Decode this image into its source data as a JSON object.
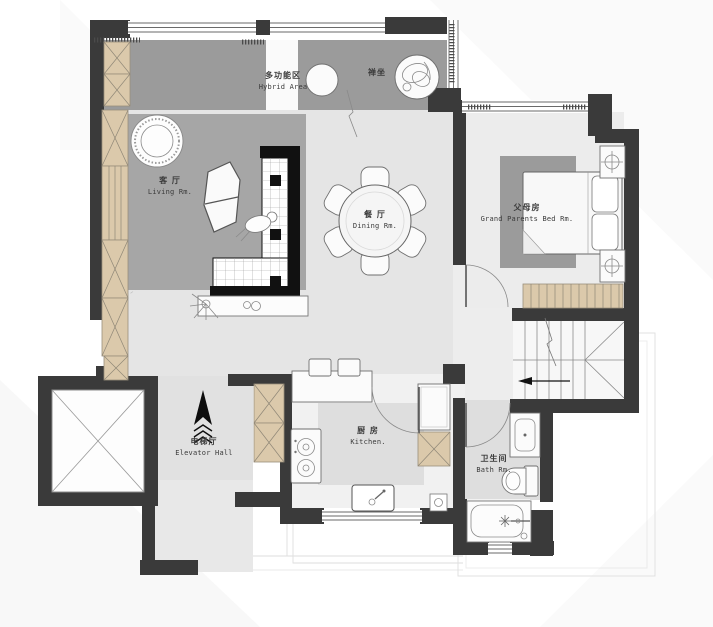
{
  "plan": {
    "title": "residential-floor-plan",
    "rooms": {
      "hybrid": {
        "zh": "多功能区",
        "en": "Hybrid Area"
      },
      "zen": {
        "zh": "禅坐",
        "en": ""
      },
      "living": {
        "zh": "客 厅",
        "en": "Living Rm."
      },
      "dining": {
        "zh": "餐 厅",
        "en": "Dining Rm."
      },
      "parents_bed": {
        "zh": "父母房",
        "en": "Grand Parents Bed Rm."
      },
      "elevator_hall": {
        "zh": "电梯厅",
        "en": "Elevator Hall"
      },
      "kitchen": {
        "zh": "厨 房",
        "en": "Kitchen."
      },
      "bath": {
        "zh": "卫生间",
        "en": "Bath Rm."
      }
    },
    "icons": {
      "direction": "north-up-arrow",
      "elevator_shaft": "x-cross-shaft",
      "stairs": "stair-run-with-arrow"
    },
    "colors": {
      "wall": "#3a3a3a",
      "cabinet_tan": "#dbc9ab",
      "rug": "#a6a6a6",
      "rug_dark": "#9b9b9b",
      "floor": "#e5e5e5",
      "floor_dim": "#dedede",
      "label": "#3a3a3a"
    }
  }
}
